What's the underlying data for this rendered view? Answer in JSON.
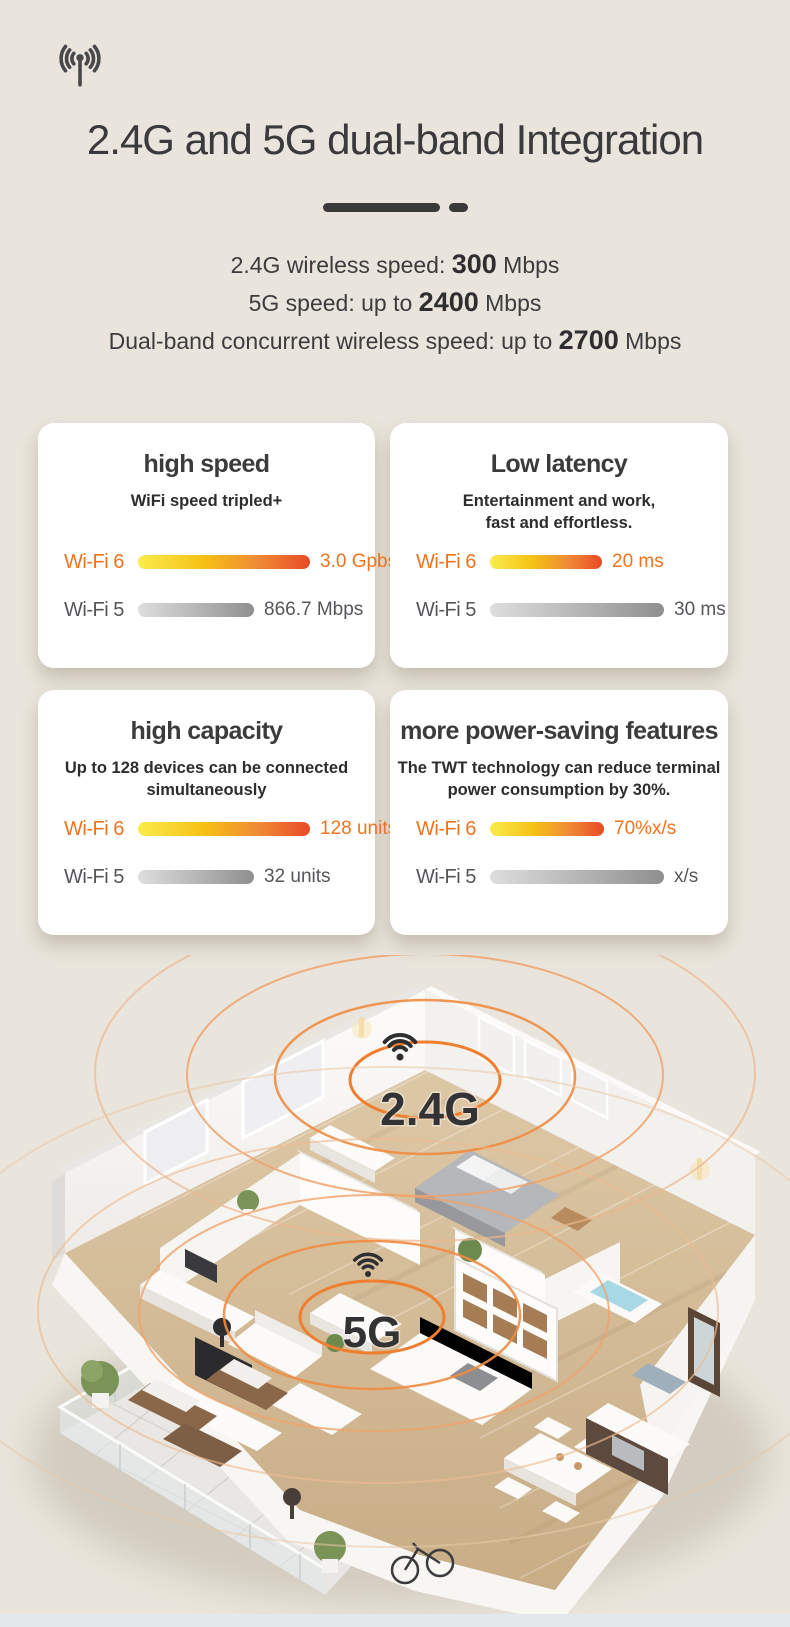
{
  "page": {
    "background": "#e9e5dc",
    "bottom_strip": "#e3e8ed"
  },
  "header": {
    "icon": "antenna-icon",
    "title": "2.4G and 5G dual-band Integration",
    "speed_lines": [
      {
        "prefix": "2.4G wireless speed: ",
        "value": "300",
        "suffix": " Mbps"
      },
      {
        "prefix": "5G speed: up to ",
        "value": "2400",
        "suffix": " Mbps"
      },
      {
        "prefix": "Dual-band concurrent wireless speed: up to ",
        "value": "2700",
        "suffix": " Mbps"
      }
    ]
  },
  "cards": [
    {
      "title": "high speed",
      "subtitle": "WiFi speed tripled+",
      "wifi6": {
        "label": "Wi-Fi 6",
        "value": "3.0 Gpbs",
        "bar_px": 172
      },
      "wifi5": {
        "label": "Wi-Fi 5",
        "value": "866.7 Mbps",
        "bar_px": 116
      }
    },
    {
      "title": "Low latency",
      "subtitle": "Entertainment and work,\nfast and effortless.",
      "wifi6": {
        "label": "Wi-Fi 6",
        "value": "20 ms",
        "bar_px": 112
      },
      "wifi5": {
        "label": "Wi-Fi 5",
        "value": "30 ms",
        "bar_px": 174
      }
    },
    {
      "title": "high capacity",
      "subtitle": "Up to 128 devices can be connected\nsimultaneously",
      "wifi6": {
        "label": "Wi-Fi 6",
        "value": "128 units",
        "bar_px": 172
      },
      "wifi5": {
        "label": "Wi-Fi 5",
        "value": "32 units",
        "bar_px": 116
      }
    },
    {
      "title": "more power-saving features",
      "subtitle": "The TWT technology can reduce terminal\npower consumption by 30%.",
      "wifi6": {
        "label": "Wi-Fi 6",
        "value": "70%x/s",
        "bar_px": 114
      },
      "wifi5": {
        "label": "Wi-Fi 5",
        "value": "x/s",
        "bar_px": 174
      }
    }
  ],
  "floorplan": {
    "labels": [
      {
        "text": "2.4G",
        "icon": "wifi-signal-icon"
      },
      {
        "text": "5G",
        "icon": "wifi-signal-icon"
      }
    ],
    "ring_color": "#ef8a3c"
  },
  "colors": {
    "accent_orange": "#f2731d",
    "wifi6_bar_start": "#f9ec4d",
    "wifi6_bar_mid": "#f6c114",
    "wifi6_bar_end": "#e84b25",
    "wifi5_bar_start": "#dedede",
    "wifi5_bar_end": "#8f8f8f",
    "title_color": "#3a3a3c",
    "card_background": "#ffffff"
  }
}
